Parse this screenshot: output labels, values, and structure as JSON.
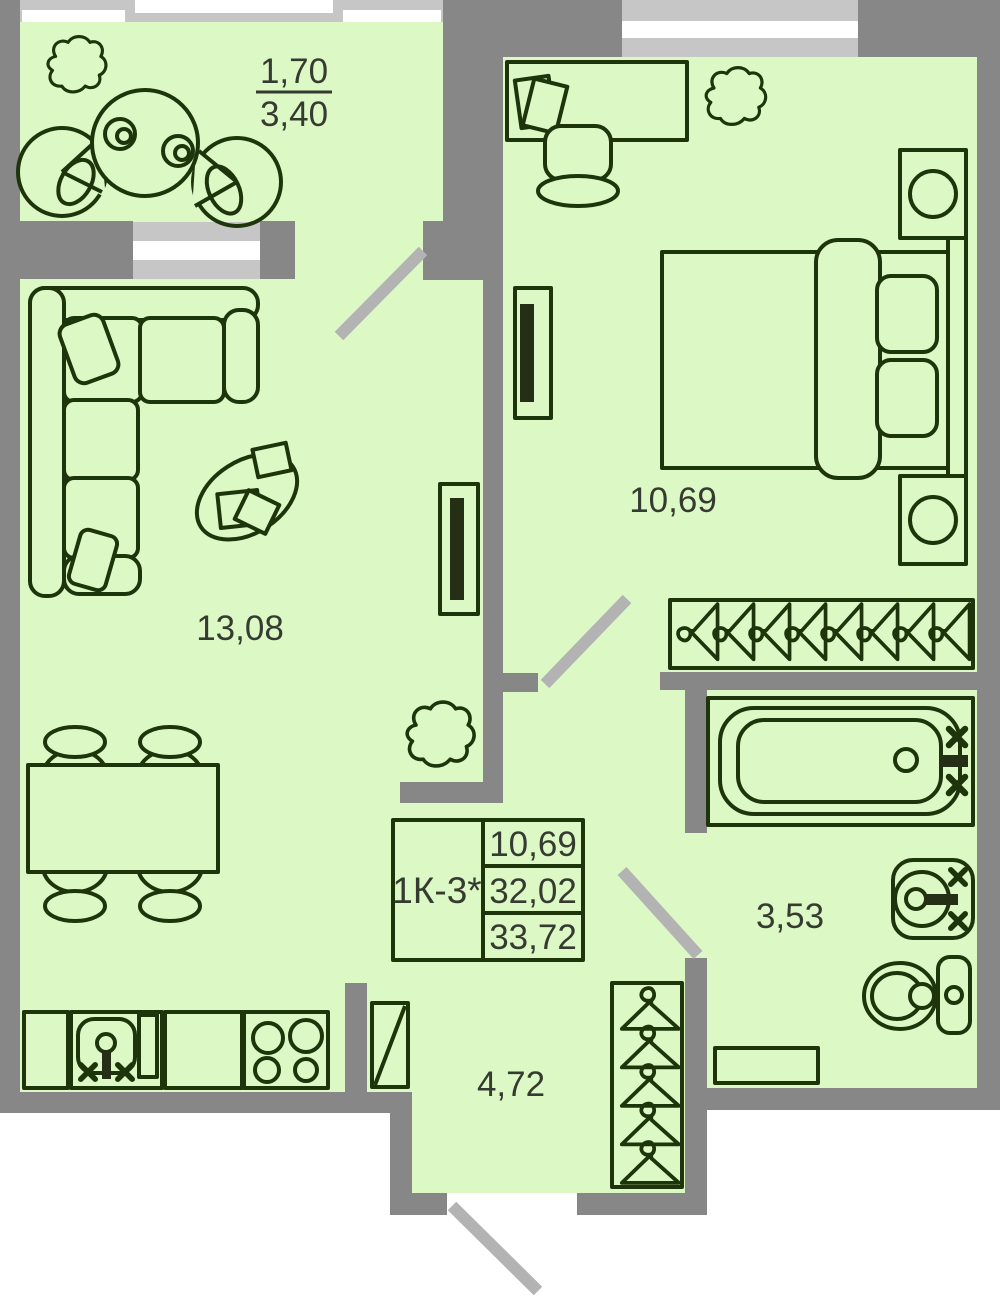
{
  "floorplan": {
    "unit_label": "1К-3*",
    "balcony": {
      "area_coef": "1,70",
      "area_total": "3,40"
    },
    "living": {
      "area": "13,08"
    },
    "bedroom": {
      "area": "10,69"
    },
    "bathroom": {
      "area": "3,53"
    },
    "hall": {
      "area": "4,72"
    },
    "info_table": {
      "unit": "1К-3*",
      "row1": "10,69",
      "row2": "32,02",
      "row3": "33,72"
    },
    "colors": {
      "room_fill": "#dcf8c5",
      "wall": "#878787",
      "window_frame": "#c6c6c6",
      "window_glass": "#ffffff",
      "furniture_line": "#1e350c",
      "door_swing": "#b3b3b3",
      "label_text": "#363b31"
    }
  }
}
